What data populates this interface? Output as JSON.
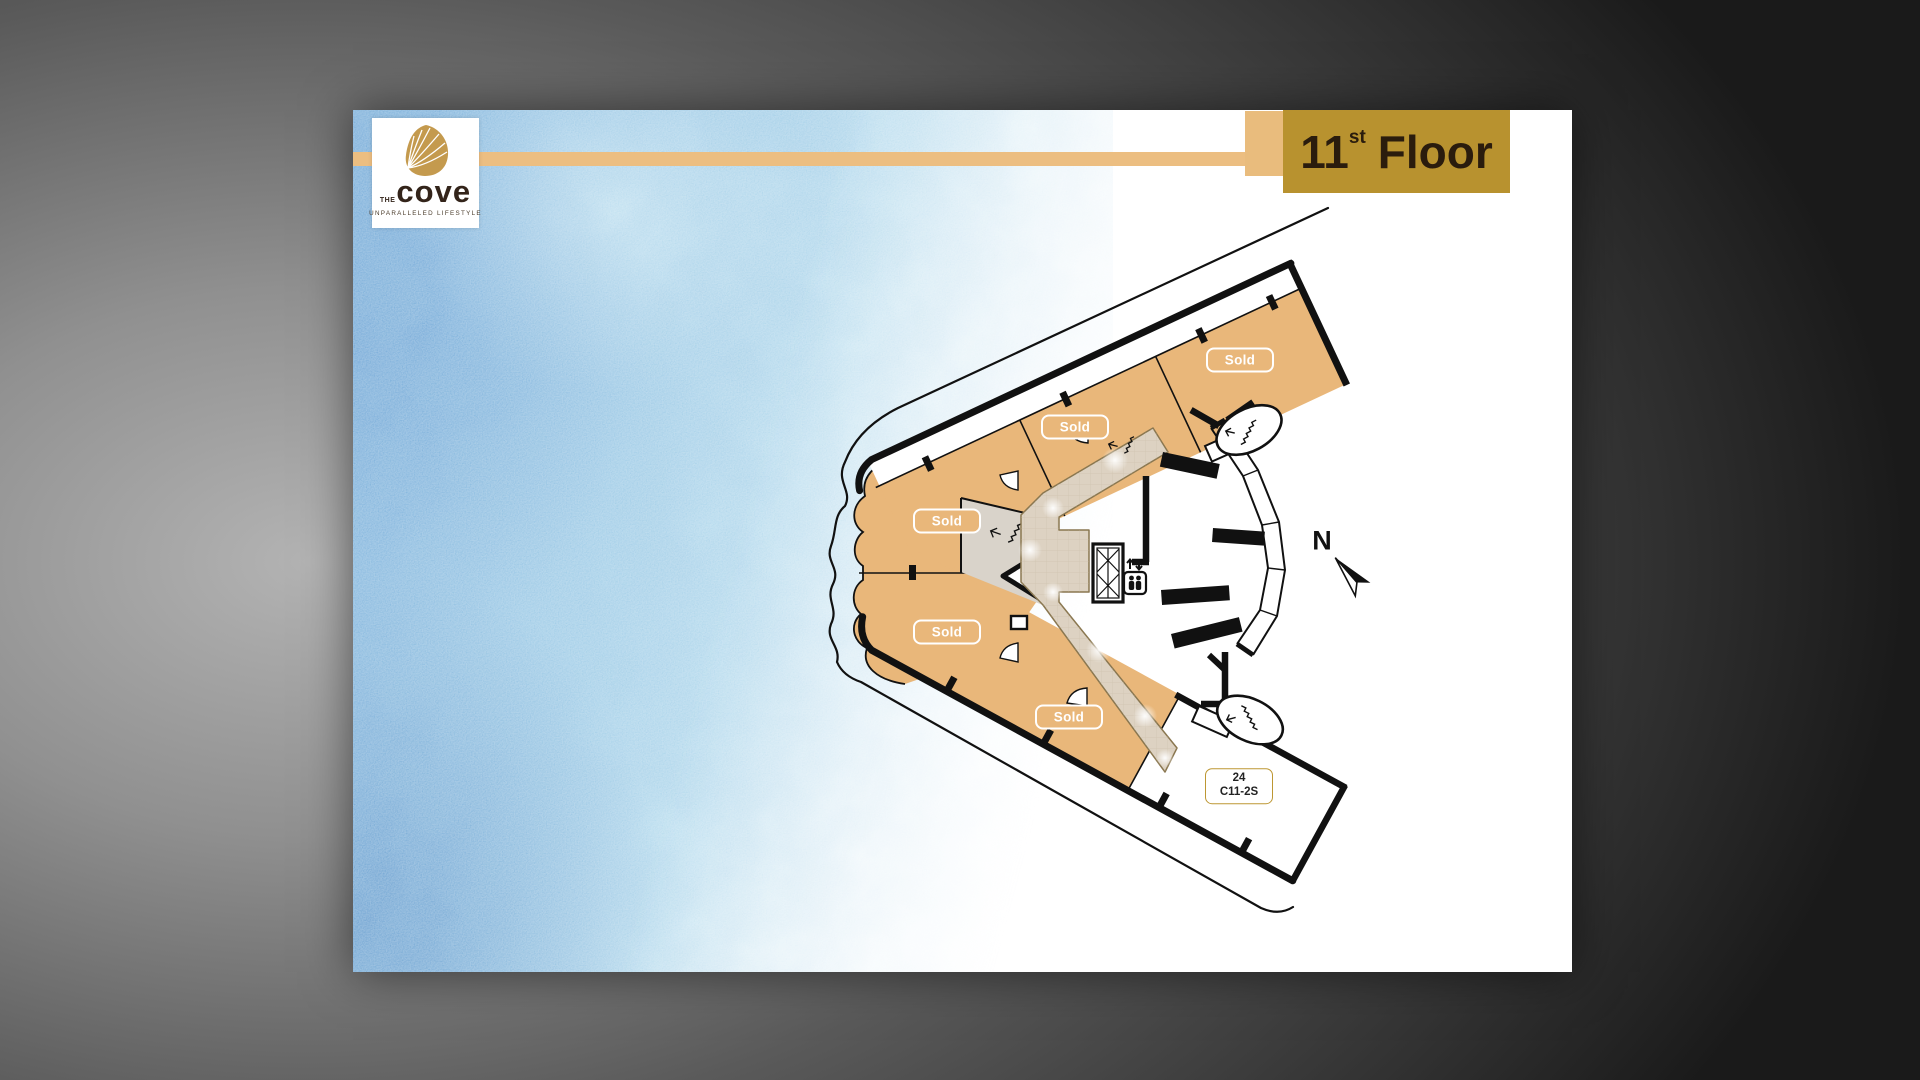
{
  "header": {
    "floor_number": "11",
    "floor_ordinal": "st",
    "floor_word": "Floor",
    "accent_bar_color": "#ecbe81",
    "banner_color": "#b8922f"
  },
  "logo": {
    "the": "THE",
    "name": "cove",
    "tagline": "UNPARALLELED  LIFESTYLE",
    "shell_color": "#c49a4e"
  },
  "plan": {
    "sold_labels": [
      "Sold",
      "Sold",
      "Sold",
      "Sold",
      "Sold"
    ],
    "unit_label": {
      "number": "24",
      "code": "C11-2S"
    },
    "compass": "N",
    "unit_fill_color": "#e9b77a",
    "corridor_color": "#ddd2c2",
    "watercolor_color": "#5b9ad0"
  }
}
